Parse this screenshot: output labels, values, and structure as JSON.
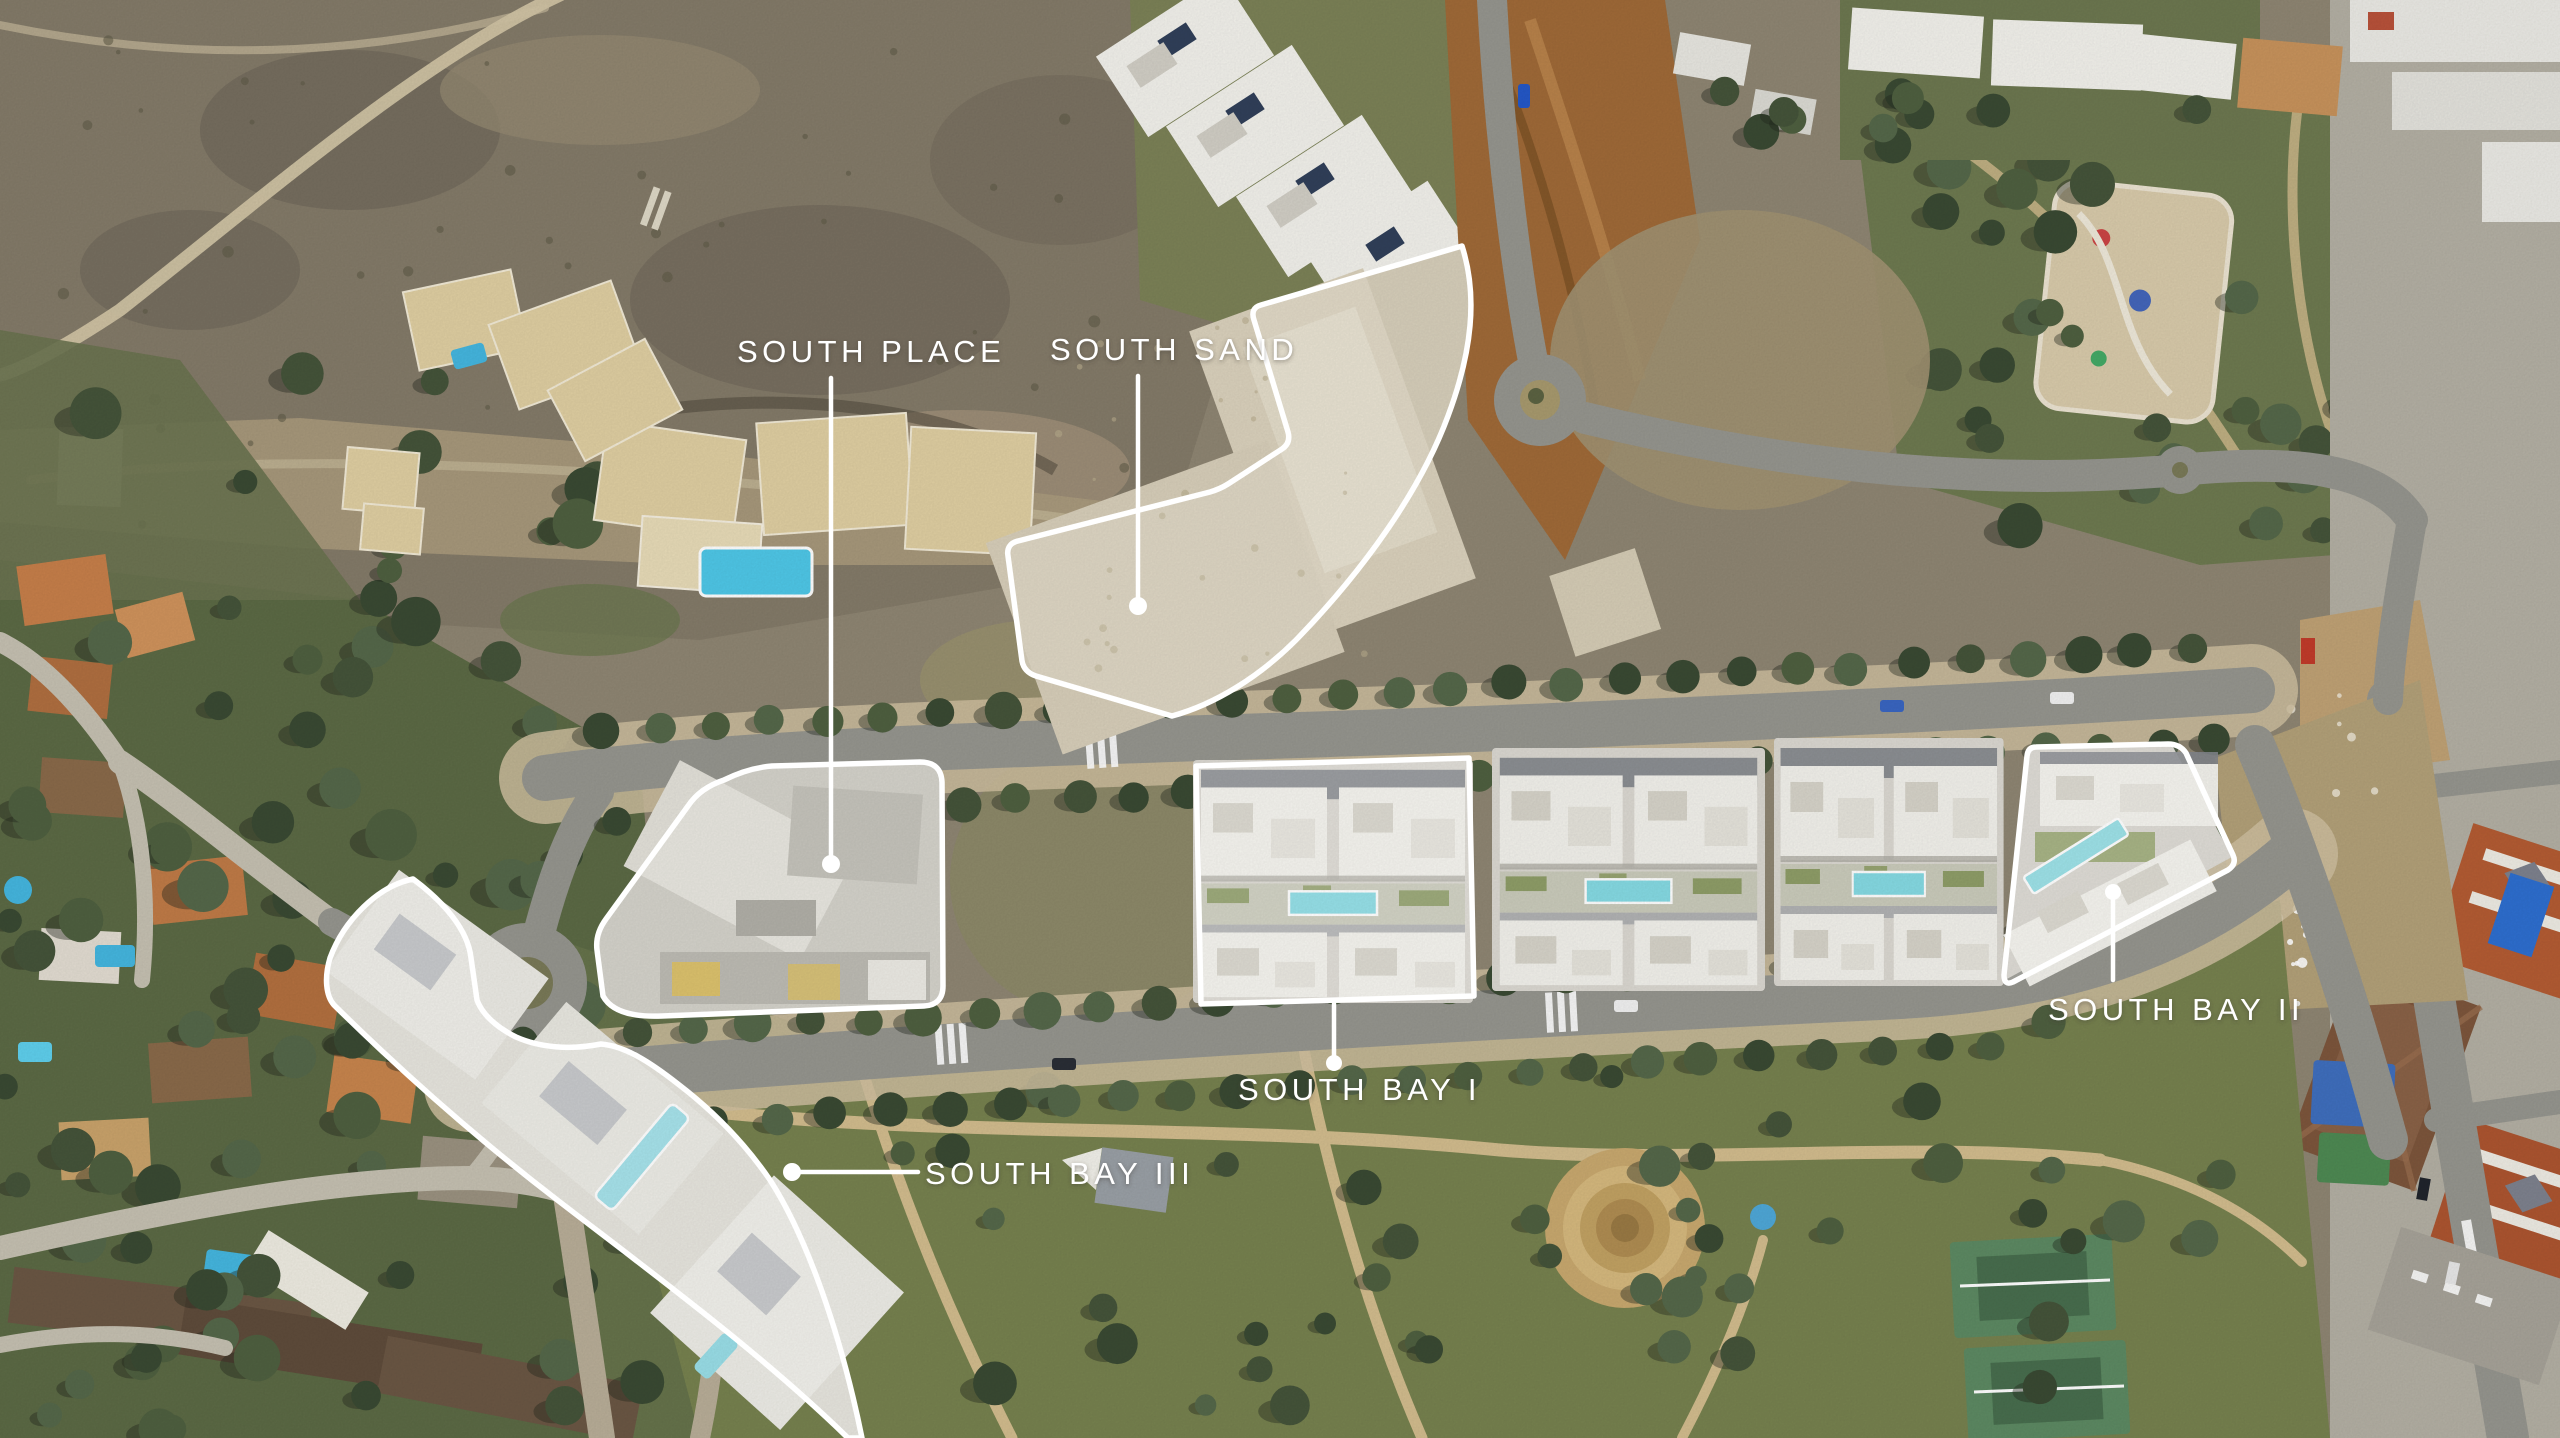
{
  "map": {
    "kind": "aerial-development-site-plan",
    "labels": [
      {
        "id": "south-place",
        "text": "SOUTH PLACE"
      },
      {
        "id": "south-sand",
        "text": "SOUTH SAND"
      },
      {
        "id": "south-bay-1",
        "text": "SOUTH BAY I"
      },
      {
        "id": "south-bay-2",
        "text": "SOUTH BAY II"
      },
      {
        "id": "south-bay-3",
        "text": "SOUTH BAY III"
      }
    ],
    "overlay": {
      "outline_color": "#ffffff",
      "label_color": "#ffffff",
      "pool_color": "#86dbe4",
      "terracotta_color": "#b45c33",
      "scrub_color": "#8a8170"
    }
  }
}
